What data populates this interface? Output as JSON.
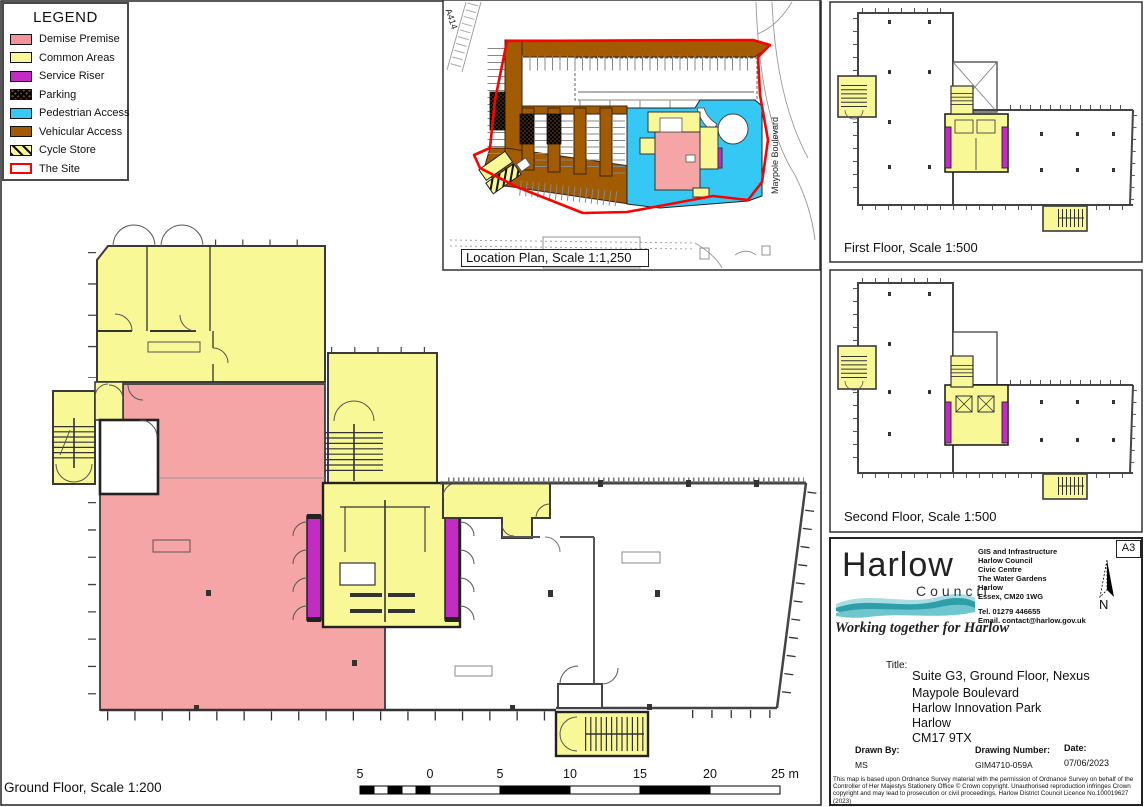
{
  "legend": {
    "title": "LEGEND",
    "items": [
      {
        "key": "demise",
        "label": "Demise Premise",
        "color": "#F2929B"
      },
      {
        "key": "common",
        "label": "Common Areas",
        "color": "#F9F896"
      },
      {
        "key": "riser",
        "label": "Service Riser",
        "color": "#C32BC3"
      },
      {
        "key": "parking",
        "label": "Parking",
        "color": "#3C2409"
      },
      {
        "key": "pedestrian",
        "label": "Pedestrian Access",
        "color": "#35C8F5"
      },
      {
        "key": "vehicular",
        "label": "Vehicular Access",
        "color": "#A25B00"
      },
      {
        "key": "cycle",
        "label": "Cycle Store",
        "color": "#F9F896"
      },
      {
        "key": "site",
        "label": "The Site",
        "color": "#FF0000"
      }
    ]
  },
  "location_plan": {
    "label": "Location Plan, Scale 1:1,250",
    "road_a414": "A414",
    "road_maypole": "Maypole Boulevard"
  },
  "first_floor": {
    "label": "First Floor, Scale 1:500"
  },
  "second_floor": {
    "label": "Second Floor, Scale 1:500"
  },
  "ground_floor": {
    "label": "Ground Floor, Scale 1:200"
  },
  "scale_bar": {
    "labels": [
      "5",
      "0",
      "5",
      "10",
      "15",
      "20",
      "25 m"
    ]
  },
  "title_block": {
    "logo": {
      "name": "Harlow",
      "sub": "Council",
      "tagline": "Working together for Harlow"
    },
    "paper_size": "A3",
    "north_label": "N",
    "address_lines": [
      "GIS and Infrastructure",
      "Harlow Council",
      "Civic Centre",
      "The Water Gardens",
      "Harlow",
      "Essex, CM20 1WG"
    ],
    "tel": "Tel. 01279 446655",
    "email": "Email. contact@harlow.gov.uk",
    "title_label": "Title:",
    "title_lines": [
      "Suite G3, Ground Floor, Nexus",
      "Maypole Boulevard",
      "Harlow Innovation Park",
      "Harlow",
      "CM17 9TX"
    ],
    "drawn_by_label": "Drawn By:",
    "drawn_by": "MS",
    "drawing_number_label": "Drawing Number:",
    "drawing_number": "GIM4710-059A",
    "date_label": "Date:",
    "date": "07/06/2023",
    "copyright": "This map is based upon Ordnance Survey material with the permission of Ordnance Survey on behalf of the Controller of Her Majestys Stationery Office © Crown copyright.  Unauthorised reproduction infringes Crown copyright and may lead to prosecution or civil proceedings.  Harlow District Council Licence No.100019627 (2023)"
  },
  "colors": {
    "demise_plan": "#F5A5A5",
    "common": "#F9F896",
    "service_riser": "#C32BC3",
    "pedestrian": "#35C8F5",
    "vehicular": "#A25B00",
    "site_red": "#FF0000",
    "wall": "#3a3a3a",
    "logo_teal": "#2E9FA9"
  }
}
